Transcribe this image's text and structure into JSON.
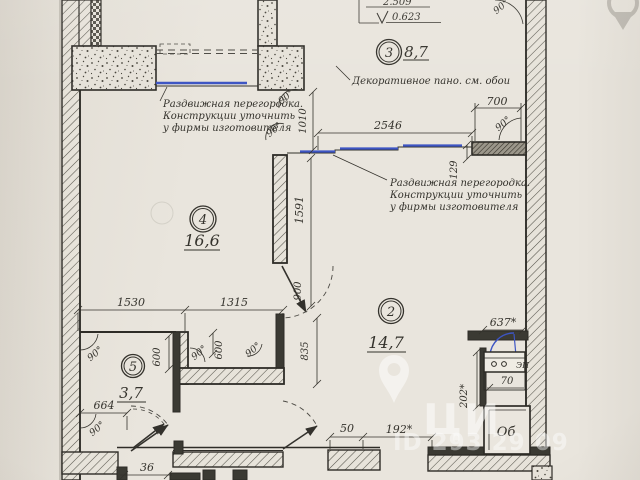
{
  "drawing_type": "floor-plan",
  "colors": {
    "paper": "#e9e5dd",
    "line": "#34322c",
    "partition_blue": "#3d55c4",
    "watermark_white": "#ffffff"
  },
  "rooms": {
    "r2": {
      "number": "2",
      "area": "14,7"
    },
    "r3": {
      "number": "3",
      "area": "8,7"
    },
    "r4": {
      "number": "4",
      "area": "16,6"
    },
    "r5": {
      "number": "5",
      "area": "3,7"
    }
  },
  "levels": {
    "upper": "2.509",
    "lower": "0.623"
  },
  "notes": {
    "partition": [
      "Раздвижная перегородка.",
      "Конструкции уточнить",
      "у фирмы изготовителя"
    ],
    "decor": "Декоративное пано. см. обои"
  },
  "dims": {
    "w700": "700",
    "w2546": "2546",
    "h1010": "1010",
    "h129": "129",
    "h1591": "1591",
    "w1530": "1530",
    "w1315": "1315",
    "v600": "600",
    "d900": "900",
    "h835": "835",
    "w664": "664",
    "w36": "36",
    "w50": "50",
    "w192": "192*",
    "w637": "637*",
    "h202": "202*",
    "w70": "70"
  },
  "angles": {
    "right": "90°"
  },
  "fixtures": {
    "stove": "ЭП",
    "ob": "Об"
  },
  "watermark": {
    "brand": "ЦИ",
    "id_text": "ID 293 29 09"
  }
}
